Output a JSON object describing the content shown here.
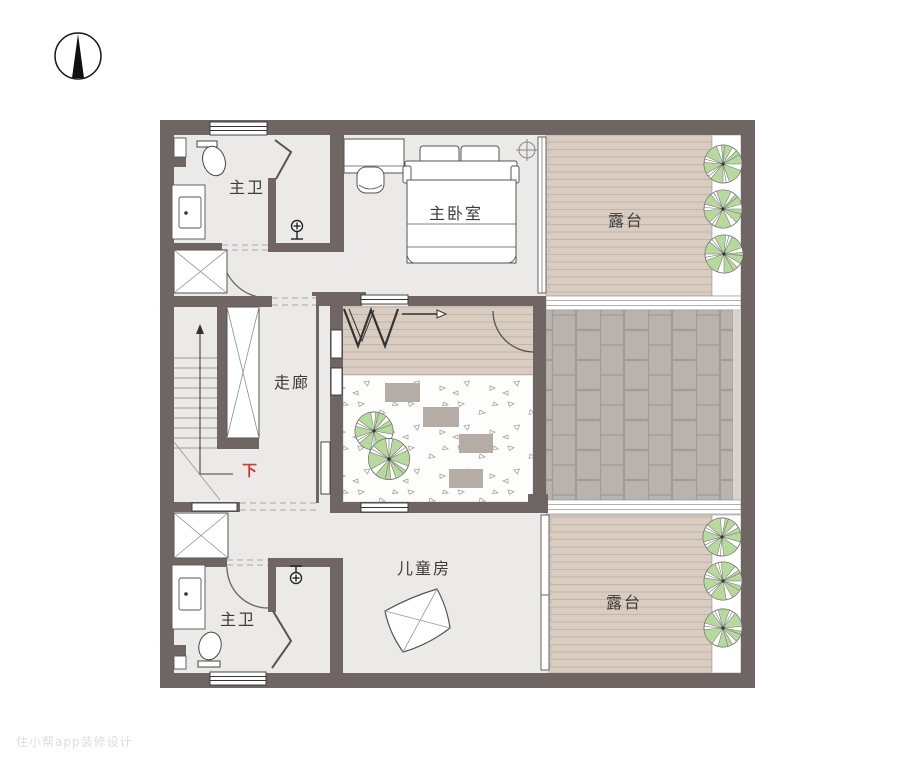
{
  "compass": {
    "icon": "north-compass-icon"
  },
  "rooms": {
    "master_bath_top": {
      "label": "主卫"
    },
    "master_bedroom": {
      "label": "主卧室"
    },
    "terrace_top": {
      "label": "露台"
    },
    "corridor": {
      "label": "走廊"
    },
    "kids_room": {
      "label": "儿童房"
    },
    "terrace_bottom": {
      "label": "露台"
    },
    "master_bath_bottom": {
      "label": "主卫"
    }
  },
  "stairs": {
    "direction_label": "下"
  },
  "watermark": {
    "text": "住小帮app装修设计"
  },
  "colors": {
    "wall": "#6F6663",
    "floor": "#ECEAE9",
    "deck": "#D9CDC2",
    "deck_line": "#C4B4A6",
    "tile": "#B8B3AF",
    "tile_joint": "#A29C98",
    "tree_green": "#B7D99E",
    "stone": "#B6ACA6",
    "down_red": "#D3382E"
  },
  "icons": [
    "north-compass-icon",
    "tree-icon",
    "toilet-icon",
    "sink-icon",
    "shower-head-icon",
    "bed-icon",
    "pillow-icon",
    "wardrobe-icon",
    "stool-icon",
    "stairs-icon",
    "shaft-icon",
    "ceiling-light-icon",
    "door-arc-icon",
    "rug-icon",
    "stepping-stone-icon"
  ]
}
